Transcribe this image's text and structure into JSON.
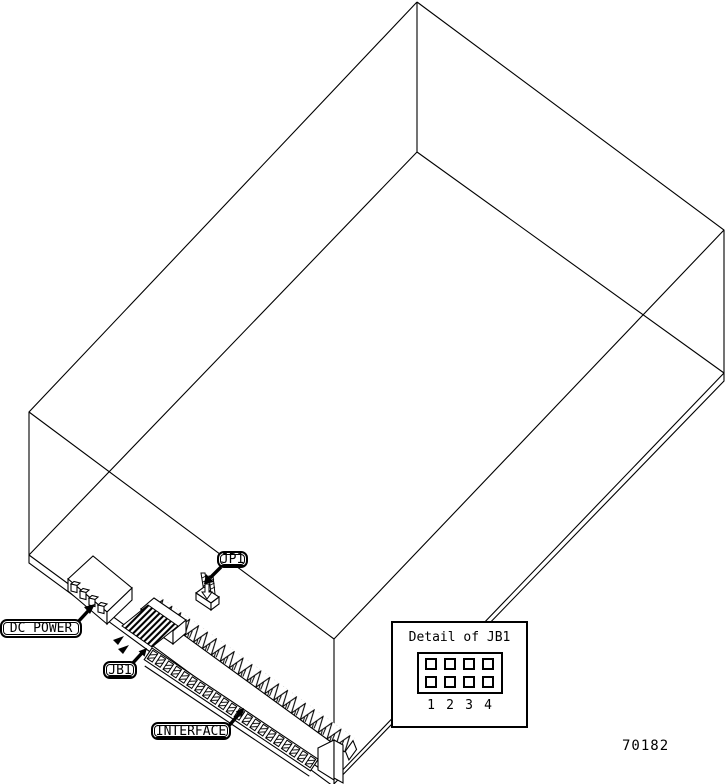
{
  "figure_number": "70182",
  "colors": {
    "line": "#000000",
    "background": "#ffffff"
  },
  "labels": {
    "dc_power": "DC POWER",
    "jb1": "JB1",
    "jp1": "JP1",
    "interface": "INTERFACE"
  },
  "detail_box": {
    "title": "Detail of JB1",
    "pin_numbers": [
      "1",
      "2",
      "3",
      "4"
    ],
    "rows": 2,
    "cols": 4
  }
}
